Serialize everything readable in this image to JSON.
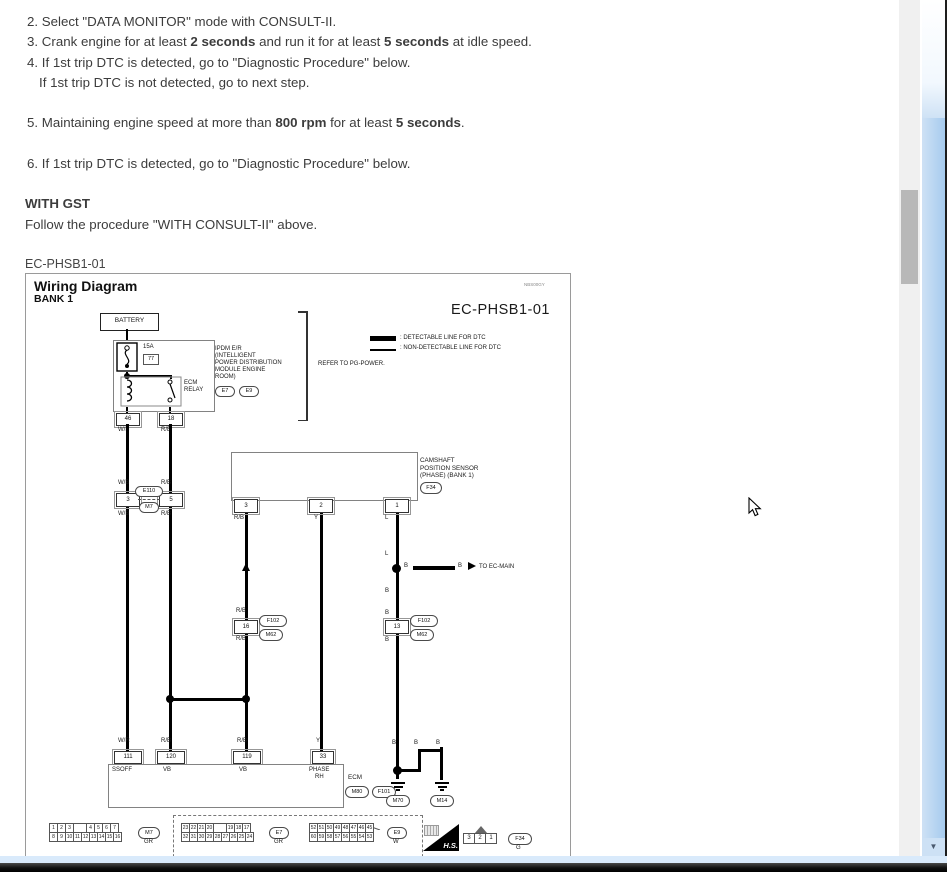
{
  "doc": {
    "step2": "2. Select \"DATA MONITOR\" mode with CONSULT-II.",
    "step3_a": "3. Crank engine for at least ",
    "step3_b": "2 seconds",
    "step3_c": " and run it for at least ",
    "step3_d": "5 seconds",
    "step3_e": " at idle speed.",
    "step4": "4. If 1st trip DTC is detected, go to \"Diagnostic Procedure\" below.",
    "step4b": "If 1st trip DTC is not detected, go to next step.",
    "step5_a": "5. Maintaining engine speed at more than ",
    "step5_b": "800 rpm",
    "step5_c": " for at least ",
    "step5_d": "5 seconds",
    "step5_e": ".",
    "step6": "6. If 1st trip DTC is detected, go to \"Diagnostic Procedure\" below.",
    "gst_heading": "WITH GST",
    "gst_body": "Follow the procedure \"WITH CONSULT-II\" above.",
    "figure_code": "EC-PHSB1-01"
  },
  "diagram": {
    "title": "Wiring Diagram",
    "subtitle": "BANK 1",
    "note_code": "NBS00GY",
    "sheet_code": "EC-PHSB1-01",
    "legend_detectable": ": DETECTABLE LINE FOR DTC",
    "legend_non_detectable": ": NON-DETECTABLE LINE FOR DTC",
    "battery": "BATTERY",
    "fuse_amp": "15A",
    "fuse_slot": "77",
    "ipdm_lines": [
      "IPDM E/R",
      "(INTELLIGENT",
      "POWER DISTRIBUTION",
      "MODULE ENGINE",
      "ROOM)"
    ],
    "relay_line1": "ECM",
    "relay_line2": "RELAY",
    "refer": "REFER TO PG-POWER.",
    "sensor_lines": [
      "CAMSHAFT",
      "POSITION SENSOR",
      "(PHASE) (BANK 1)"
    ],
    "to_ec_main": "TO EC-MAIN",
    "ecm_label": "ECM",
    "ecm_pin_names": {
      "p111": "SSOFF",
      "p120": "VB",
      "p119": "VB",
      "p33a": "PHASE",
      "p33b": "RH"
    },
    "pins": {
      "ipdm_left": "46",
      "ipdm_right": "18",
      "j1_left": "3",
      "j1_right": "5",
      "sensor_3": "3",
      "sensor_2": "2",
      "sensor_1": "1",
      "j2_left": "16",
      "j2_right": "13",
      "ecm_111": "111",
      "ecm_120": "120",
      "ecm_119": "119",
      "ecm_33": "33"
    },
    "connectors": {
      "e7": "E7",
      "e9": "E9",
      "f34": "F34",
      "j1_top": "E110",
      "j1_bottom": "M7",
      "j2_top": "F102",
      "j2_bottom": "M62",
      "ecm_a": "M80",
      "ecm_b": "F101",
      "gnd_left": "M70",
      "gnd_right": "M14"
    },
    "wires": {
      "wb": "W/B",
      "rb": "R/B",
      "wr": "W/R",
      "y": "Y",
      "l": "L",
      "b": "B"
    },
    "strip": {
      "m7": {
        "row1": [
          "1",
          "2",
          "3",
          "",
          "4",
          "5",
          "6",
          "7"
        ],
        "row2": [
          "8",
          "9",
          "10",
          "11",
          "12",
          "13",
          "14",
          "15",
          "16"
        ],
        "label": "M7",
        "color": "GR"
      },
      "e7": {
        "row1": [
          "23",
          "22",
          "21",
          "20",
          "",
          "19",
          "18",
          "17"
        ],
        "row2": [
          "32",
          "31",
          "30",
          "29",
          "28",
          "27",
          "26",
          "25",
          "24"
        ],
        "label": "E7",
        "color": "GR"
      },
      "e9": {
        "row1": [
          "52",
          "51",
          "50",
          "49",
          "48",
          "47",
          "46",
          "45"
        ],
        "row2": [
          "60",
          "59",
          "58",
          "57",
          "56",
          "55",
          "54",
          "53"
        ],
        "label": "E9",
        "color": "W"
      },
      "hs": "H.S.",
      "f34": {
        "cells": [
          "3",
          "2",
          "1"
        ],
        "label": "F34",
        "color": "G"
      }
    }
  },
  "icons": {
    "scroll_down": "▼"
  },
  "colors": {
    "accent_blue": "#a9cdec",
    "taskbar": "#111111"
  }
}
